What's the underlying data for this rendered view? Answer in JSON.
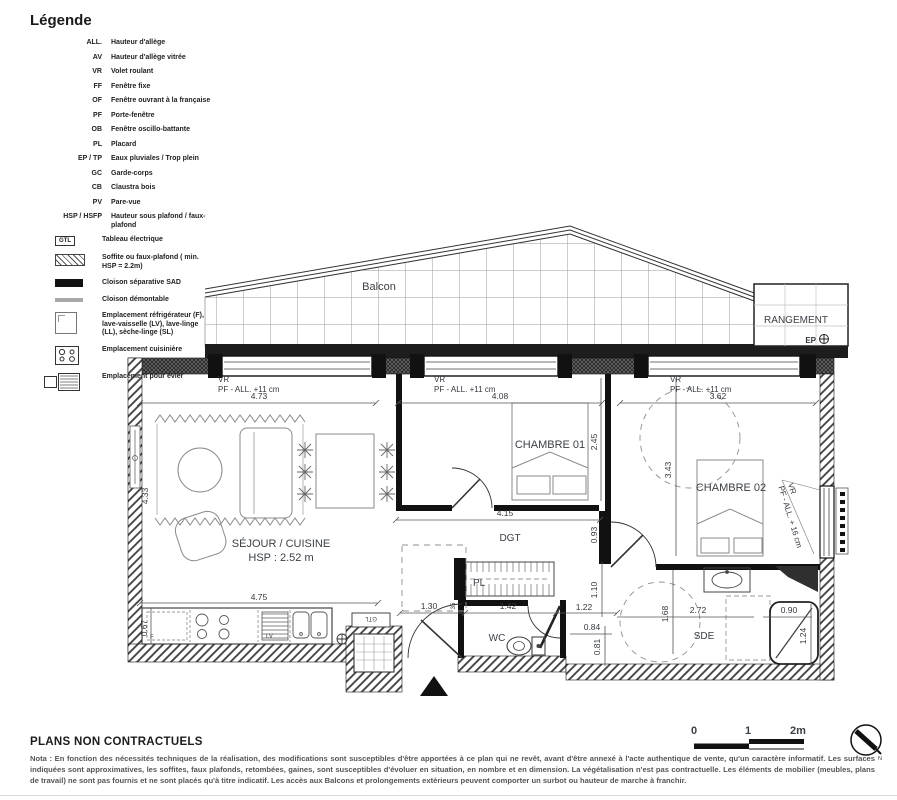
{
  "legend": {
    "title": "Légende",
    "abbreviations": [
      {
        "abbr": "ALL.",
        "label": "Hauteur d'allège"
      },
      {
        "abbr": "AV",
        "label": "Hauteur d'allège vitrée"
      },
      {
        "abbr": "VR",
        "label": "Volet roulant"
      },
      {
        "abbr": "FF",
        "label": "Fenêtre fixe"
      },
      {
        "abbr": "OF",
        "label": "Fenêtre ouvrant à la française"
      },
      {
        "abbr": "PF",
        "label": "Porte-fenêtre"
      },
      {
        "abbr": "OB",
        "label": "Fenêtre oscillo-battante"
      },
      {
        "abbr": "PL",
        "label": "Placard"
      },
      {
        "abbr": "EP / TP",
        "label": "Eaux pluviales / Trop plein"
      },
      {
        "abbr": "GC",
        "label": "Garde-corps"
      },
      {
        "abbr": "CB",
        "label": "Claustra bois"
      },
      {
        "abbr": "PV",
        "label": "Pare-vue"
      },
      {
        "abbr": "HSP / HSFP",
        "label": "Hauteur sous plafond / faux-plafond"
      }
    ],
    "gtl": {
      "abbr": "GTL",
      "label": "Tableau électrique"
    },
    "symbols": [
      {
        "label": "Soffite ou faux-plafond ( min. HSP = 2.2m)"
      },
      {
        "label": "Cloison séparative SAD"
      },
      {
        "label": "Cloison démontable"
      },
      {
        "label": "Emplacement réfrigérateur (F), lave-vaisselle (LV), lave-linge (LL), sèche-linge (SL)"
      },
      {
        "label": "Emplacement cuisinière"
      },
      {
        "label": "Emplacement pour évier"
      }
    ]
  },
  "plan": {
    "balcon": "Balcon",
    "rangement": "RANGEMENT",
    "ep": "EP",
    "win1_a": "VR",
    "win1_b": "PF - ALL. +11 cm",
    "win2_a": "VR",
    "win2_b": "PF - ALL. +11 cm",
    "win3_a": "VR",
    "win3_b": "PF - ALL. +11 cm",
    "winr_a": "VR",
    "winr_b": "PF - ALL. + 16 cm",
    "chambre01": "CHAMBRE 01",
    "chambre02": "CHAMBRE 02",
    "sejour": "SÉJOUR / CUISINE",
    "hsp": "HSP : 2.52 m",
    "dgt": "DGT",
    "pl": "PL",
    "wc": "WC",
    "sde": "SDE",
    "gtl": "GTL",
    "fridge": "F",
    "lv": "LV",
    "dims": {
      "w1": "4.73",
      "w2": "4.08",
      "w3": "3.62",
      "c1w": "4.15",
      "c1h": "2.45",
      "c2h": "3.43",
      "sejw": "4.75",
      "sejh": "4.33",
      "kdepth": "0.67",
      "entry": "1.30",
      "hall": "1.42",
      "wcw": "1.22",
      "pass": "0.84",
      "v081": "0.81",
      "v110": "1.10",
      "v093": "0.93",
      "jamb": "35",
      "sdeh": "1.68",
      "sdew": "2.72",
      "showerw": "0.90",
      "showerh": "1.24"
    }
  },
  "scalebar": {
    "t0": "0",
    "t1": "1",
    "t2": "2m"
  },
  "footer": {
    "title": "PLANS NON CONTRACTUELS",
    "nota": "Nota : En fonction des nécessités techniques de la réalisation, des modifications sont susceptibles d'être apportées à ce plan qui ne revêt, avant d'être annexé à l'acte authentique de vente, qu'un caractère informatif. Les surfaces indiquées sont approximatives, les soffites, faux plafonds, retombées, gaines, sont susceptibles d'évoluer en situation, en nombre et en dimension. La végétalisation n'est pas contractuelle. Les éléments de mobilier (meubles, plans de travail) ne sont pas fournis et ne sont placés qu'à titre indicatif. Les accès aux Balcons et prolongements extérieurs peuvent comporter un surbot ou hauteur de marche à franchir."
  }
}
